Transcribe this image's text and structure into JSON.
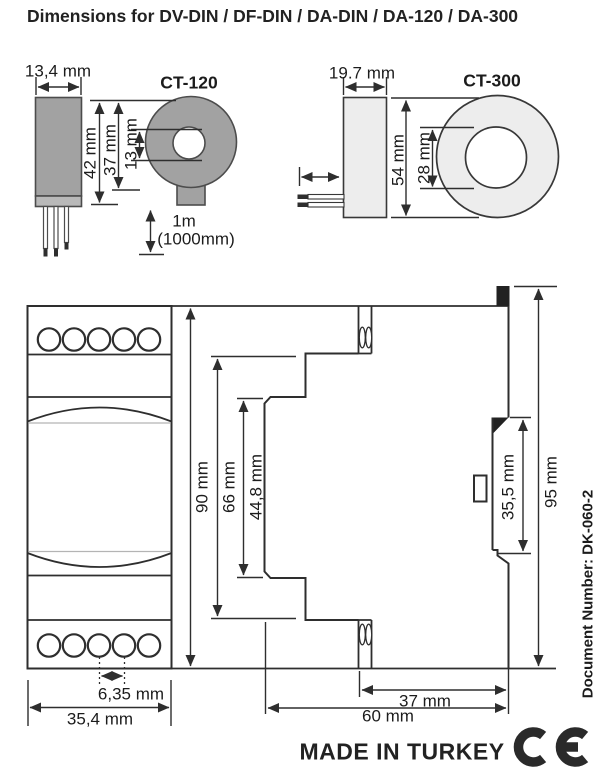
{
  "title": "Dimensions for DV-DIN / DF-DIN / DA-DIN / DA-120 / DA-300",
  "ct120": {
    "label": "CT-120",
    "body_width": "13,4 mm",
    "body_height": "42 mm",
    "ring_outer": "37 mm",
    "ring_hole": "13 mm",
    "cable_length": "1m",
    "cable_length_mm": "(1000mm)"
  },
  "ct300": {
    "label": "CT-300",
    "body_width": "19.7 mm",
    "ring_outer": "54 mm",
    "ring_hole": "28 mm"
  },
  "module": {
    "front_height": "90 mm",
    "body_height": "66 mm",
    "panel_height": "44,8 mm",
    "terminal_pitch": "6,35 mm",
    "front_width": "35,4 mm",
    "rail_recess": "35,5 mm",
    "overall_height": "95 mm",
    "rear_depth": "37 mm",
    "overall_depth": "60 mm"
  },
  "footer": {
    "made_in": "MADE IN TURKEY",
    "document_number": "Document Number: DK-060-2"
  },
  "colors": {
    "line": "#2e2e2e",
    "ct120_fill": "#a2a2a2",
    "ct300_fill": "#ededed",
    "tab_fill": "#222222"
  }
}
